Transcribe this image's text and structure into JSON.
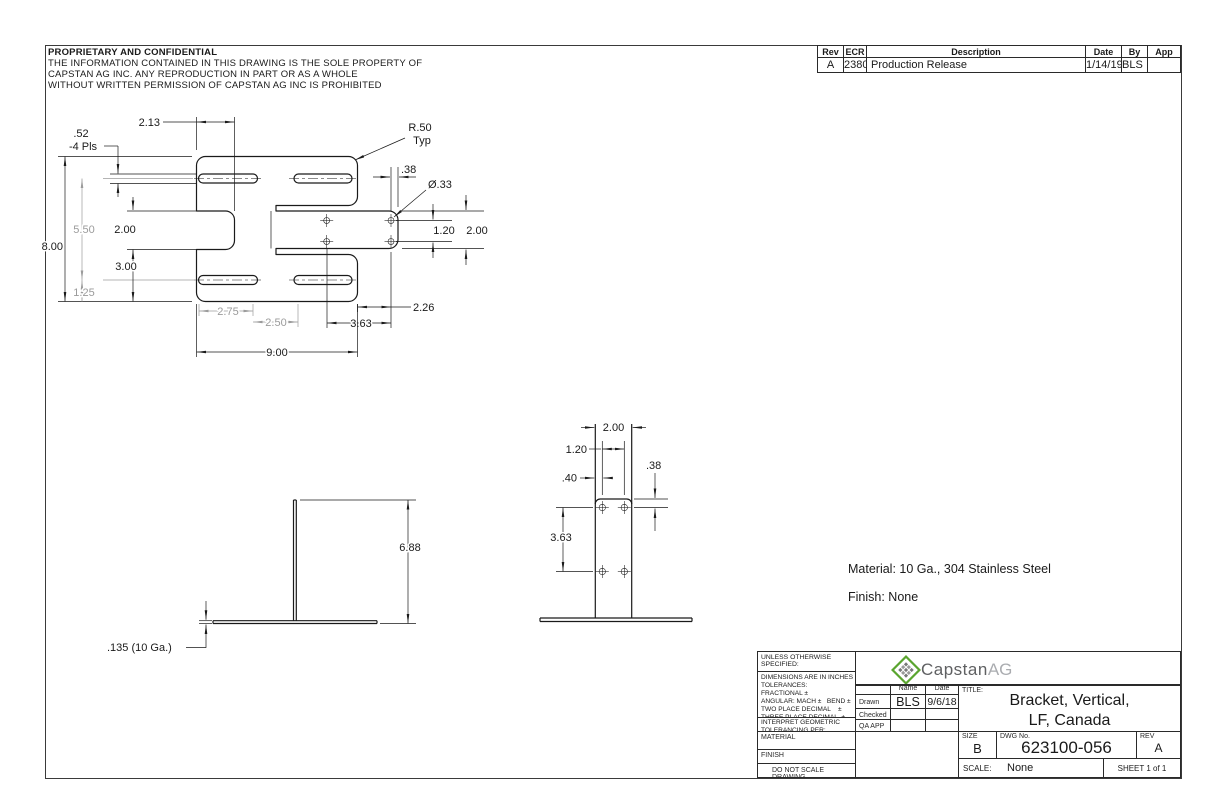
{
  "proprietary": {
    "title": "PROPRIETARY AND CONFIDENTIAL",
    "line1": "THE INFORMATION CONTAINED IN THIS DRAWING IS THE SOLE PROPERTY OF",
    "line2": "CAPSTAN AG INC. ANY REPRODUCTION IN PART OR AS A WHOLE",
    "line3": "WITHOUT WRITTEN PERMISSION OF CAPSTAN AG INC IS PROHIBITED"
  },
  "revision_table": {
    "headers": [
      "Rev",
      "ECR",
      "Description",
      "Date",
      "By",
      "App"
    ],
    "row": {
      "rev": "A",
      "ecr": "2380",
      "description": "Production Release",
      "date": "1/14/19",
      "by": "BLS",
      "app": ""
    }
  },
  "top_view": {
    "d213": "2.13",
    "d52": ".52",
    "d52_note": "-4 Pls",
    "r50": "R.50",
    "r50_note": "Typ",
    "d38": ".38",
    "dia33": "Ø.33",
    "d550": "5.50",
    "d800": "8.00",
    "d200_notch": "2.00",
    "d300": "3.00",
    "d125": "1.25",
    "d120": "1.20",
    "d200_flange": "2.00",
    "d275": "2.75",
    "d250": "2.50",
    "d363": "3.63",
    "d226": "2.26",
    "d900": "9.00"
  },
  "side_view": {
    "d688": "6.88",
    "thickness": ".135 (10 Ga.)"
  },
  "front_view": {
    "d200": "2.00",
    "d120": "1.20",
    "d40": ".40",
    "d38": ".38",
    "d363": "3.63"
  },
  "notes": {
    "material": "Material: 10 Ga., 304 Stainless Steel",
    "finish": "Finish: None"
  },
  "title_block": {
    "unless": "UNLESS OTHERWISE SPECIFIED:",
    "tol_lines": [
      "DIMENSIONS ARE IN INCHES",
      "TOLERANCES:",
      "FRACTIONAL ±",
      "ANGULAR: MACH ±   BEND ±",
      "TWO PLACE DECIMAL    ±",
      "THREE PLACE DECIMAL  ±"
    ],
    "interpret": "INTERPRET GEOMETRIC",
    "interpret2": "TOLERANCING PER:",
    "material_label": "MATERIAL",
    "finish_label": "FINISH",
    "do_not_scale": "DO NOT SCALE DRAWING",
    "name_header": "Name",
    "date_header": "Date",
    "drawn_label": "Drawn",
    "drawn_name": "BLS",
    "drawn_date": "9/6/18",
    "checked_label": "Checked",
    "qa_label": "QA APP",
    "logo_main": "Capstan",
    "logo_sub": "AG",
    "logo_green": "#5aa52f",
    "title_label": "TITLE:",
    "title_line1": "Bracket, Vertical,",
    "title_line2": "LF, Canada",
    "size_label": "SIZE",
    "size_value": "B",
    "dwg_label": "DWG No.",
    "dwg_value": "623100-056",
    "rev_label": "REV",
    "rev_value": "A",
    "scale_label": "SCALE:",
    "scale_value": "None",
    "sheet_label": "SHEET 1 of 1"
  }
}
